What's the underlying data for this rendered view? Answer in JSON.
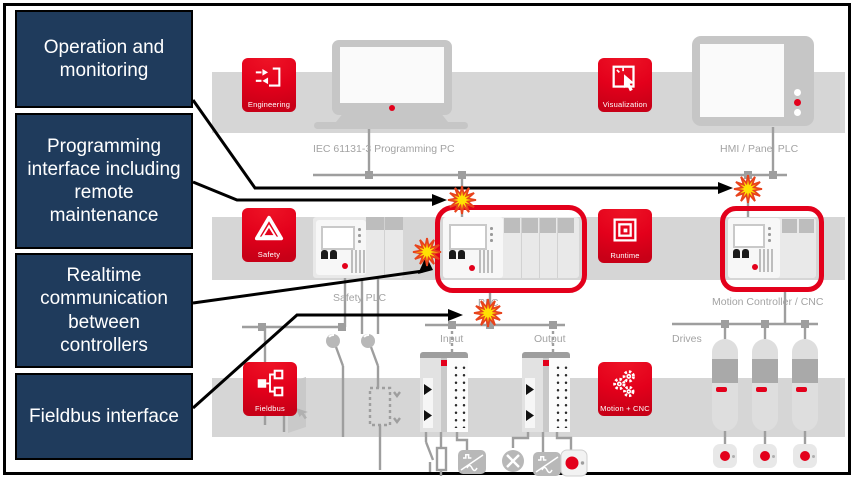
{
  "figure": {
    "type": "plc-architecture-diagram"
  },
  "callouts": [
    {
      "label": "Operation and monitoring"
    },
    {
      "label": "Programming interface including remote maintenance"
    },
    {
      "label": "Realtime communication between controllers"
    },
    {
      "label": "Fieldbus interface"
    }
  ],
  "tiles": {
    "engineering": {
      "label": "Engineering"
    },
    "visualization": {
      "label": "Visualization"
    },
    "safety": {
      "label": "Safety"
    },
    "runtime": {
      "label": "Runtime"
    },
    "fieldbus": {
      "label": "Fieldbus"
    },
    "motion_cnc": {
      "label": "Motion + CNC"
    }
  },
  "devices": {
    "programming_pc": {
      "label": "IEC 61131-3 Programming PC"
    },
    "hmi_panel": {
      "label": "HMI / Panel PLC"
    },
    "safety_plc": {
      "label": "Safety PLC"
    },
    "plc": {
      "label": "PLC"
    },
    "motion_controller": {
      "label": "Motion Controller / CNC"
    },
    "io_input": {
      "label": "Input"
    },
    "io_output": {
      "label": "Output"
    },
    "drives": {
      "label": "Drives"
    }
  },
  "colors": {
    "accent_red": "#e3001b",
    "callout_navy": "#1f3b5c",
    "band_gray": "#d6d6d6",
    "wire_gray": "#9e9e9e",
    "device_label_gray": "#a3a3a3",
    "spark_fill": "#ffe103",
    "spark_stroke": "#e8431c",
    "highlight_stroke": "#e3001b"
  }
}
